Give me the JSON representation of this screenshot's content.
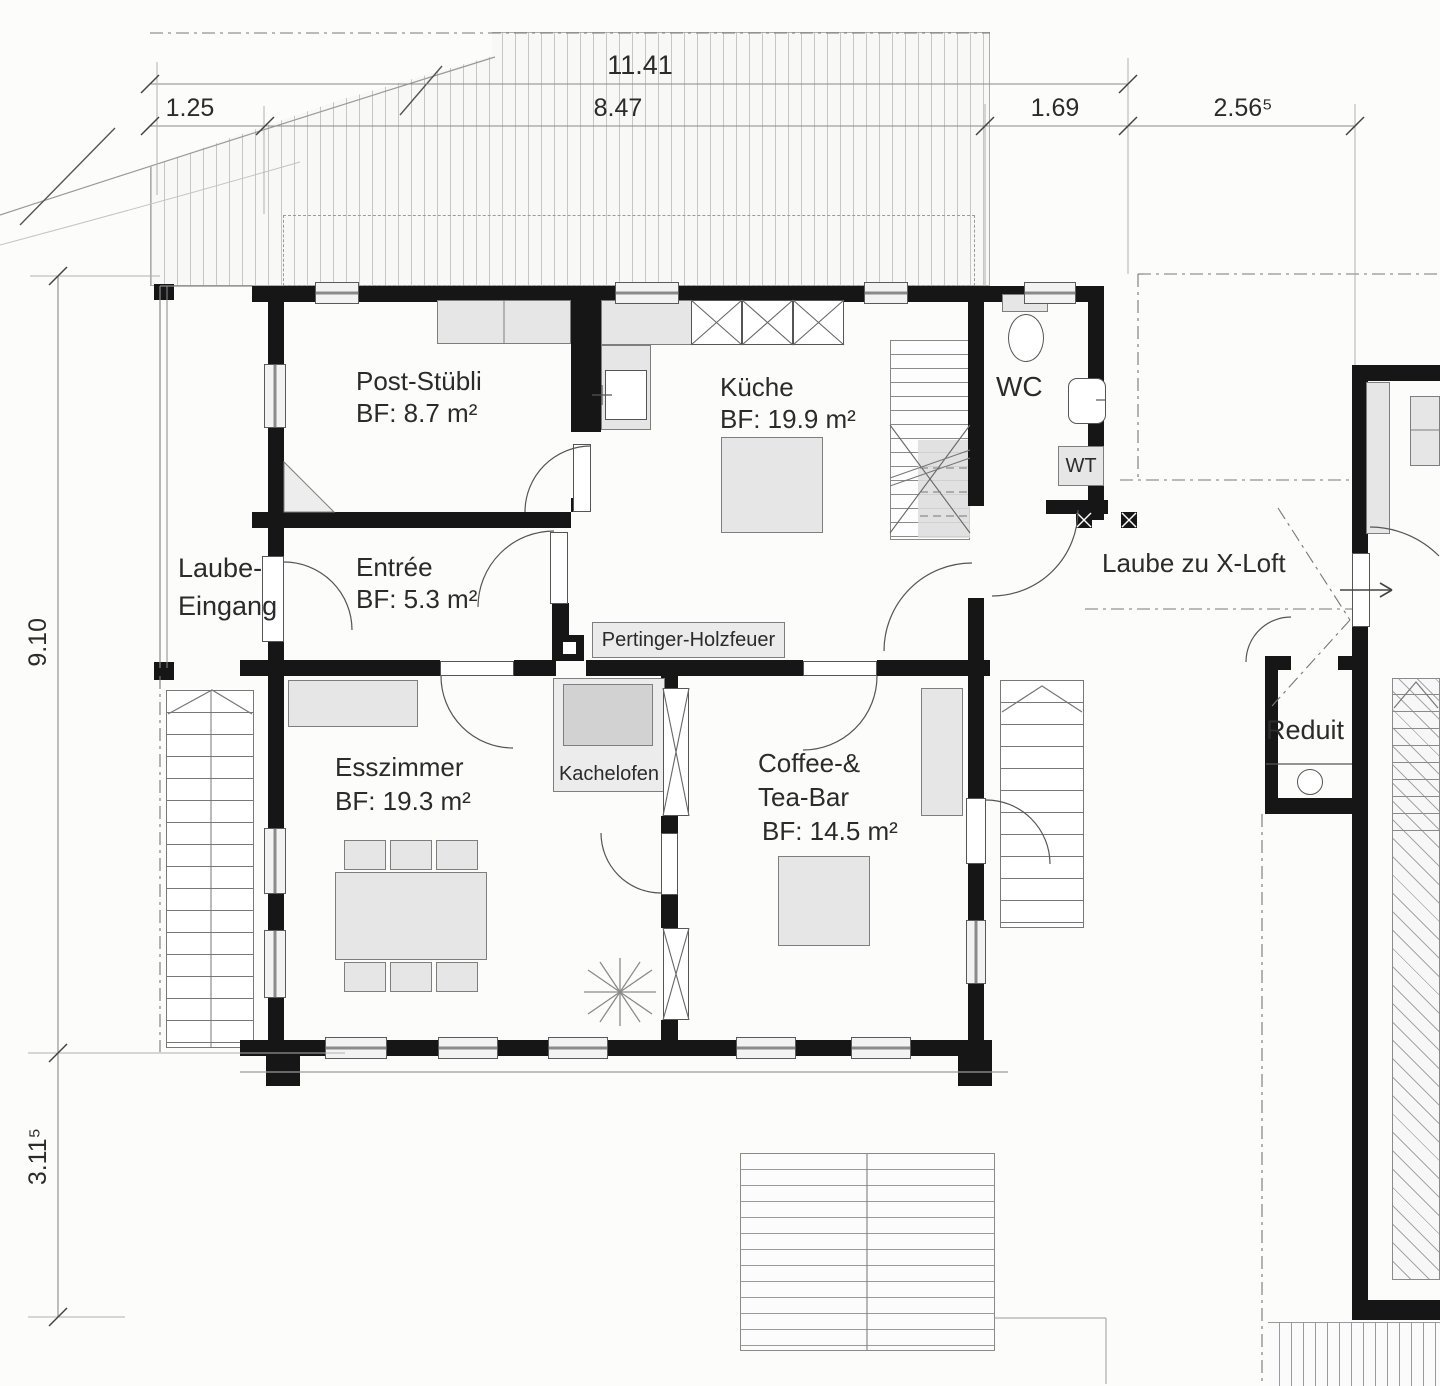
{
  "dims": {
    "total": "11.41",
    "s1": "1.25",
    "s2": "8.47",
    "s3": "1.69",
    "s4": "2.56⁵",
    "v1": "9.10",
    "v2": "3.11⁵"
  },
  "rooms": {
    "post": {
      "name": "Post-Stübli",
      "area": "BF: 8.7 m²"
    },
    "kueche": {
      "name": "Küche",
      "area": "BF: 19.9 m²"
    },
    "wc": {
      "name": "WC"
    },
    "wt": {
      "name": "WT"
    },
    "entree": {
      "name": "Entrée",
      "area": "BF: 5.3 m²"
    },
    "laube": {
      "l1": "Laube-",
      "l2": "Eingang"
    },
    "ess": {
      "name": "Esszimmer",
      "area": "BF: 19.3 m²"
    },
    "kachelofen": {
      "name": "Kachelofen"
    },
    "coffee": {
      "l1": "Coffee-&",
      "l2": "Tea-Bar",
      "area": "BF: 14.5 m²"
    },
    "xloft": {
      "name": "Laube zu X-Loft"
    },
    "reduit": {
      "name": "Reduit"
    },
    "pertinger": {
      "name": "Pertinger-Holzfeuer"
    }
  }
}
